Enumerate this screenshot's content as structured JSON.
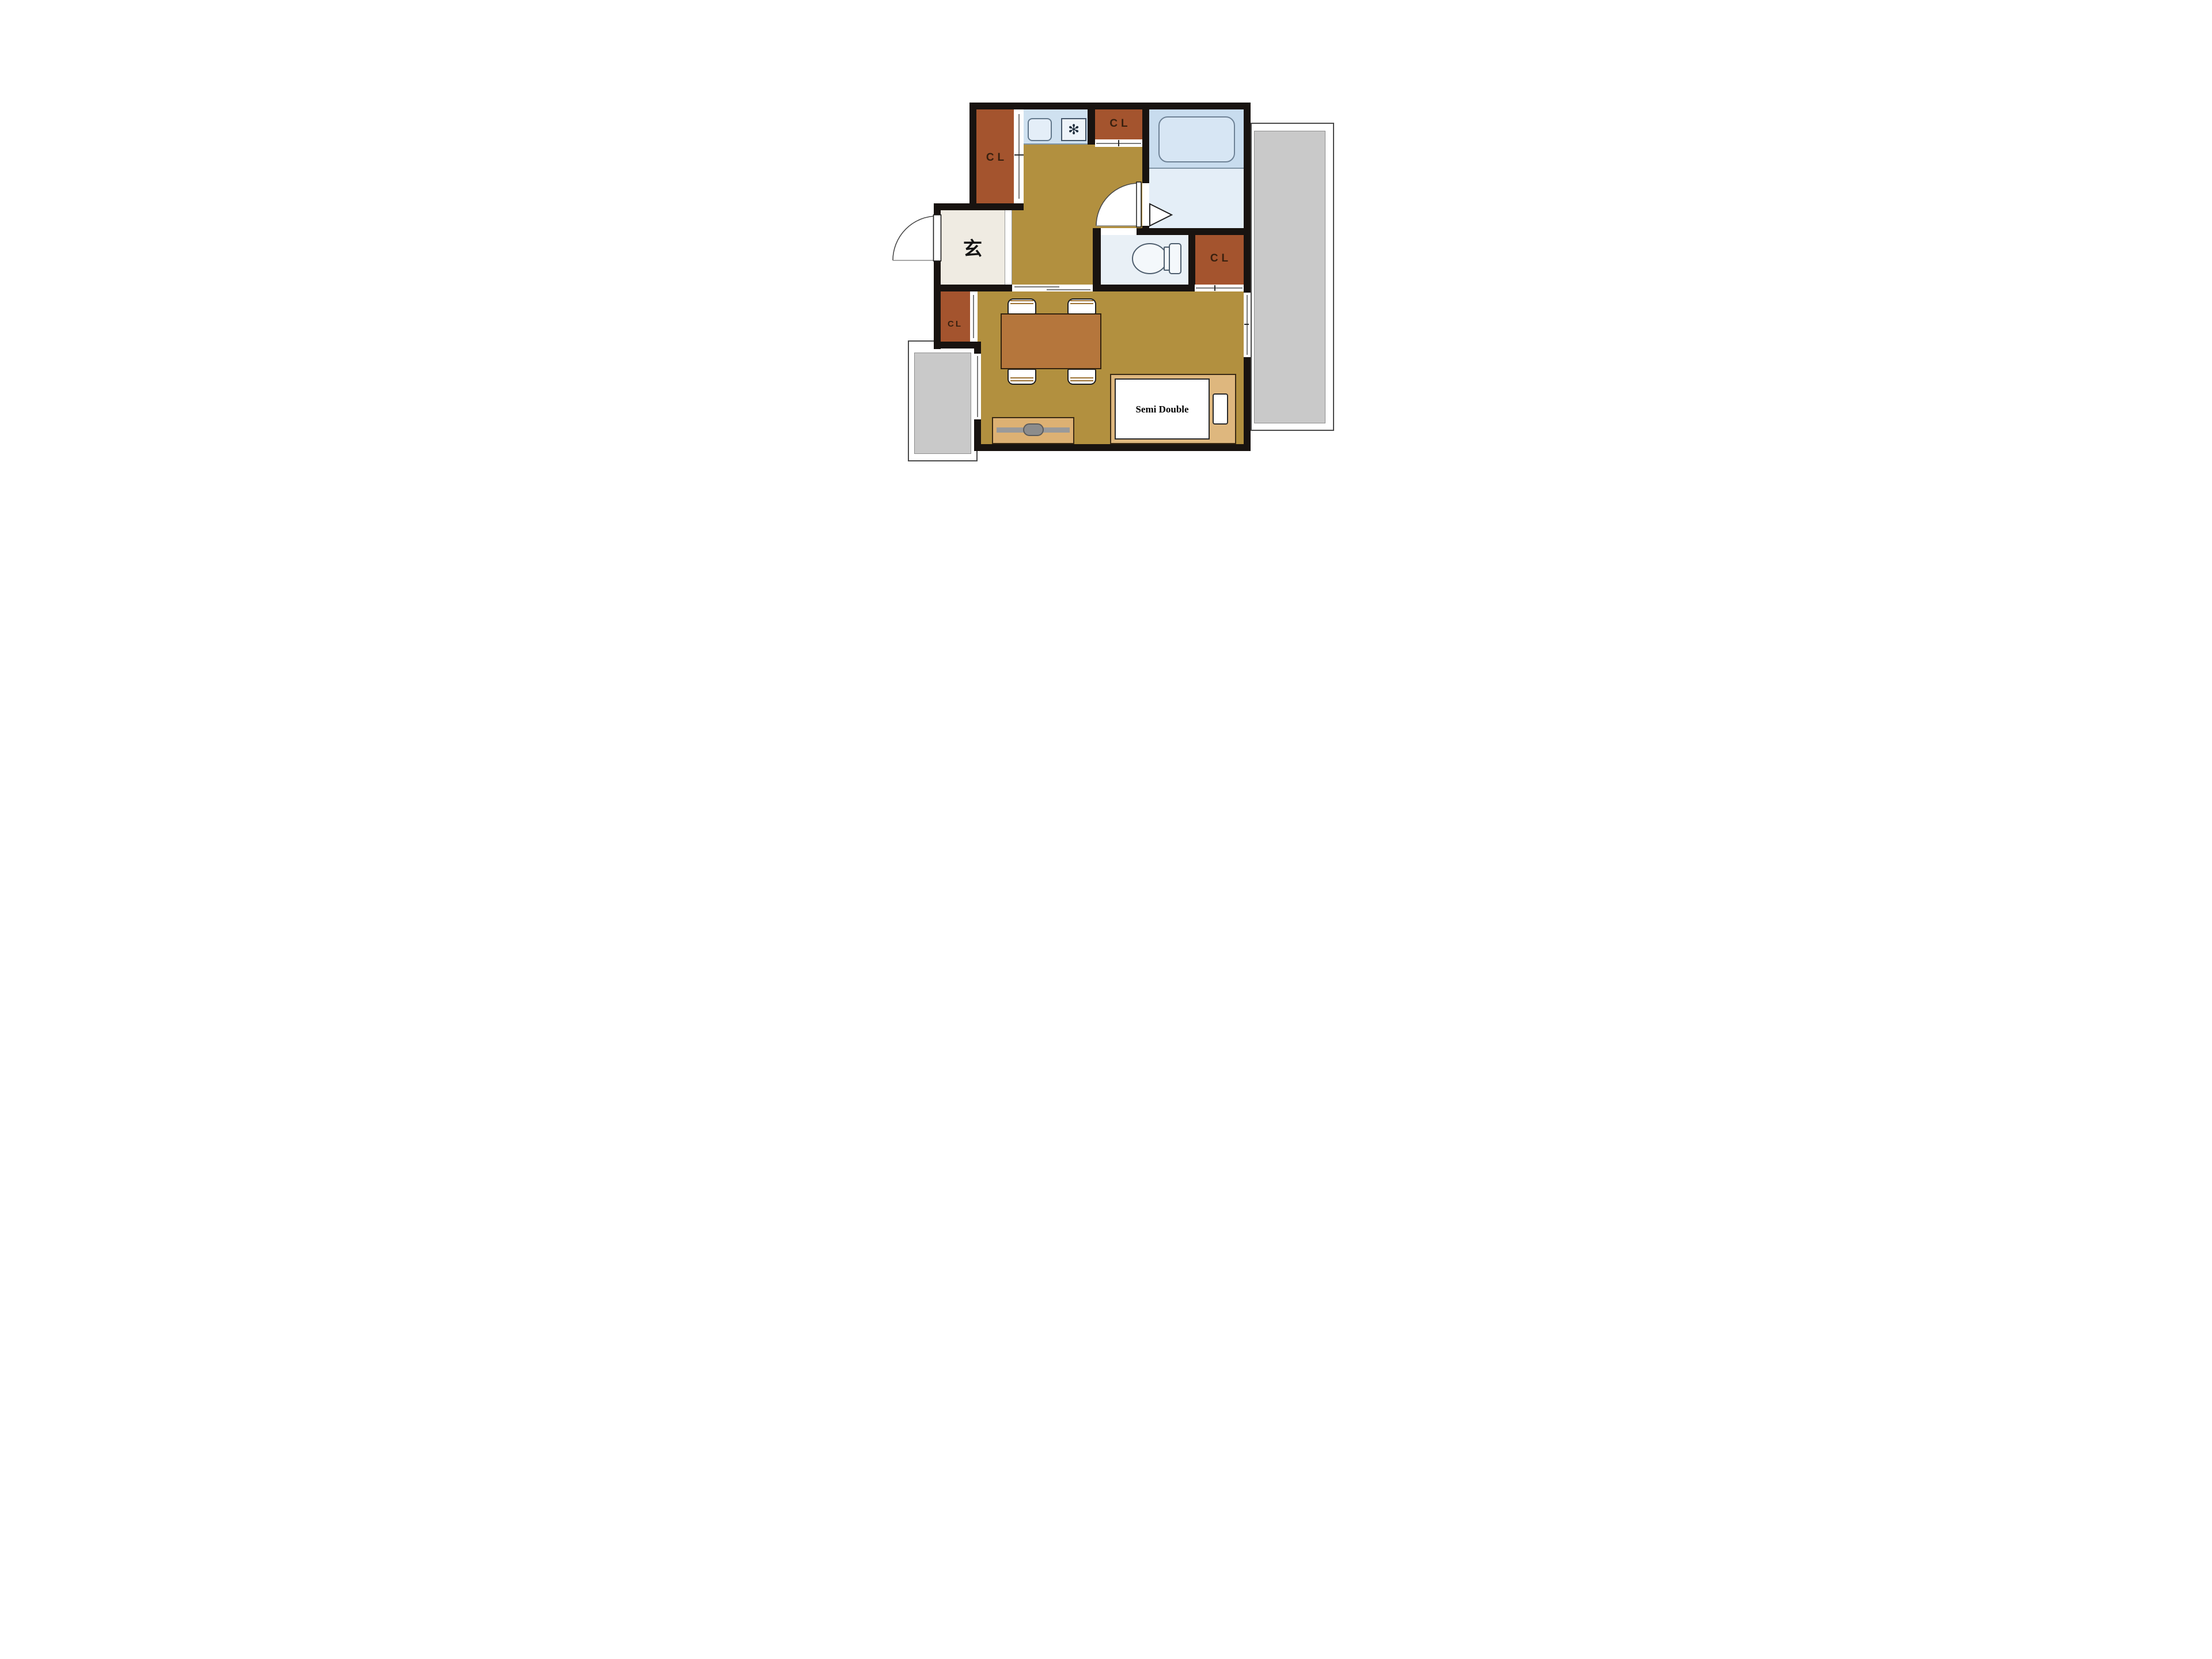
{
  "plan": {
    "labels": {
      "closet_top_left": "CL",
      "closet_top_middle": "CL",
      "closet_side": "CL",
      "closet_entry": "CL",
      "entrance": "玄",
      "bed": "Semi Double",
      "burner": "✻"
    },
    "colors": {
      "wall": "#181310",
      "flooring": "#b2903f",
      "closet_brown": "#a4542e",
      "closet_text": "#38200f",
      "entrance_floor": "#efebe2",
      "kitchen_counter": "#cfe1f0",
      "bathtub_zone": "#c8dcee",
      "washroom": "#e4eef7",
      "toilet_room": "#e9f0f6",
      "balcony_gray": "#c9c9c9",
      "dining_table": "#b5763c",
      "tv_board": "#ddb173",
      "bed_frame": "#deb77e"
    }
  }
}
